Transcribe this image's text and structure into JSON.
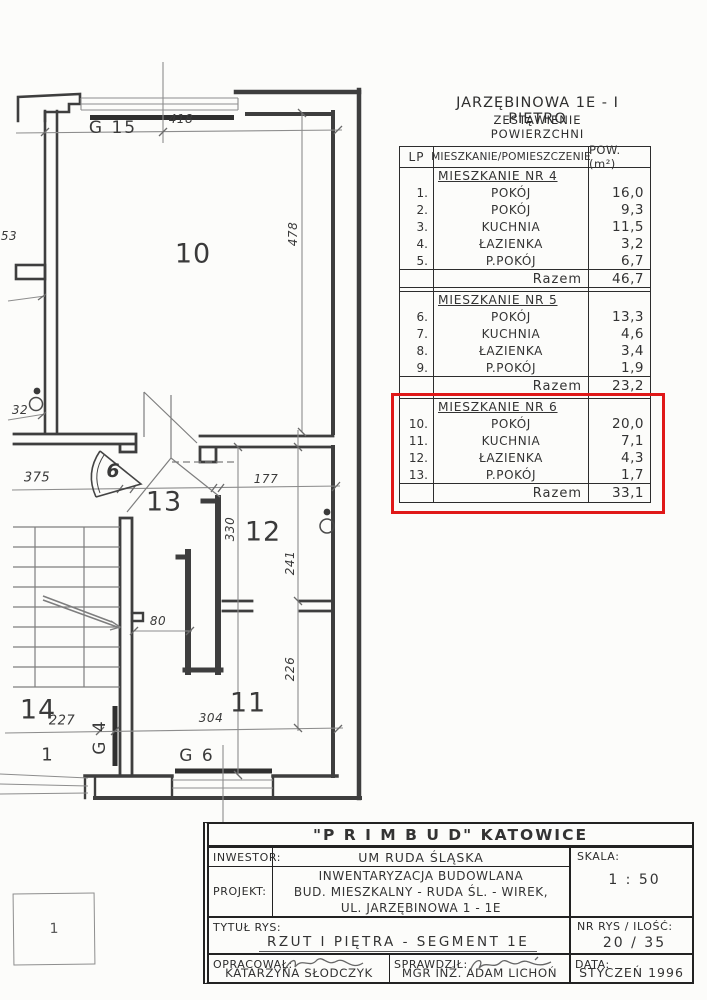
{
  "colors": {
    "highlight_red": "#e01818",
    "ink": "#333333"
  },
  "plan": {
    "rooms": {
      "r10": "10",
      "r11": "11",
      "r12": "12",
      "r13": "13",
      "r14": "14"
    },
    "marks": {
      "g15": "G 15",
      "g4": "G 4",
      "g6": "G 6",
      "apt6": "6",
      "entry1": "1"
    },
    "dims": {
      "d418": "418",
      "d478": "478",
      "d53": "53",
      "d32": "32",
      "d375": "375",
      "d177": "177",
      "d330": "330",
      "d241": "241",
      "d226": "226",
      "d80": "80",
      "d227": "227",
      "d304": "304"
    }
  },
  "table": {
    "title": "JARZĘBINOWA 1E  -  I PIĘTRO",
    "subtitle": "ZESTAWIENIE POWIERZCHNI",
    "headers": {
      "lp": "LP",
      "name": "MIESZKANIE/POMIESZCZENIE",
      "area": "POW. (m²)"
    },
    "razem_label": "Razem",
    "sections": [
      {
        "title": "MIESZKANIE NR 4",
        "rows": [
          {
            "no": "1.",
            "name": "POKÓJ",
            "area": "16,0"
          },
          {
            "no": "2.",
            "name": "POKÓJ",
            "area": "9,3"
          },
          {
            "no": "3.",
            "name": "KUCHNIA",
            "area": "11,5"
          },
          {
            "no": "4.",
            "name": "ŁAZIENKA",
            "area": "3,2"
          },
          {
            "no": "5.",
            "name": "P.POKÓJ",
            "area": "6,7"
          }
        ],
        "total": "46,7"
      },
      {
        "title": "MIESZKANIE NR 5",
        "rows": [
          {
            "no": "6.",
            "name": "POKÓJ",
            "area": "13,3"
          },
          {
            "no": "7.",
            "name": "KUCHNIA",
            "area": "4,6"
          },
          {
            "no": "8.",
            "name": "ŁAZIENKA",
            "area": "3,4"
          },
          {
            "no": "9.",
            "name": "P.POKÓJ",
            "area": "1,9"
          }
        ],
        "total": "23,2"
      },
      {
        "title": "MIESZKANIE NR 6",
        "highlighted": true,
        "rows": [
          {
            "no": "10.",
            "name": "POKÓJ",
            "area": "20,0"
          },
          {
            "no": "11.",
            "name": "KUCHNIA",
            "area": "7,1"
          },
          {
            "no": "12.",
            "name": "ŁAZIENKA",
            "area": "4,3"
          },
          {
            "no": "13.",
            "name": "P.POKÓJ",
            "area": "1,7"
          }
        ],
        "total": "33,1"
      }
    ]
  },
  "titleblock": {
    "company": "\"P R I M B U D\"  KATOWICE",
    "inwestor_label": "INWESTOR:",
    "inwestor": "UM RUDA ŚLĄSKA",
    "projekt_label": "PROJEKT:",
    "projekt_line1": "INWENTARYZACJA BUDOWLANA",
    "projekt_line2": "BUD. MIESZKALNY - RUDA ŚL. - WIREK,",
    "projekt_line3": "UL. JARZĘBINOWA 1 - 1E",
    "skala_label": "SKALA:",
    "skala": "1 : 50",
    "tytul_label": "TYTUŁ RYS:",
    "tytul": "RZUT I PIĘTRA - SEGMENT 1E",
    "nr_label": "NR RYS / ILOŚĆ:",
    "nr": "20 / 35",
    "opracowal_label": "OPRACOWAŁ:",
    "opracowal": "KATARZYNA SŁODCZYK",
    "sprawdzil_label": "SPRAWDZIŁ:",
    "sprawdzil": "MGR INŻ. ADAM LICHOŃ",
    "data_label": "DATA:",
    "data": "STYCZEŃ 1996"
  },
  "page": {
    "corner": "1"
  }
}
